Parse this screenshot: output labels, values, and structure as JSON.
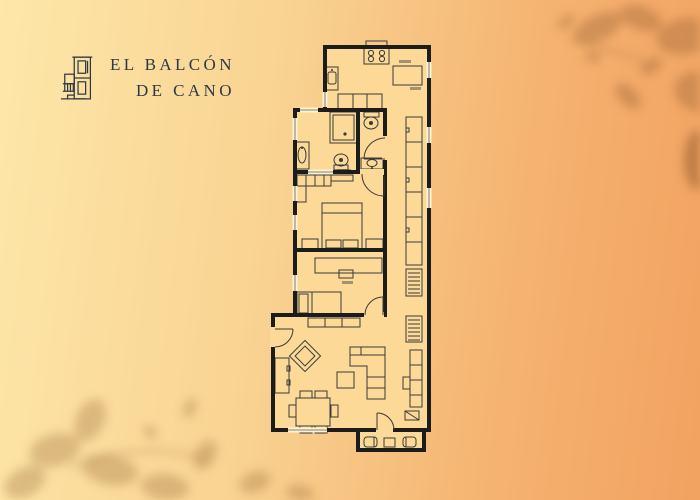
{
  "brand": {
    "line1": "EL BALCÓN",
    "line2": "DE CANO",
    "logo_icon": "building-icon"
  },
  "palette": {
    "bg_left": "#fde7a9",
    "bg_mid": "#f9d392",
    "bg_right": "#f2a261",
    "leaf_shadow": "#8a5526",
    "wall": "#1c1c1c",
    "floor": "#fcd997",
    "furniture_line": "#3a3a3a",
    "window": "#fdf2d2",
    "text": "#2e3a42"
  },
  "floorplan": {
    "regions": [
      "kitchen",
      "bathroom",
      "wc",
      "bedroom-1",
      "bedroom-2",
      "hallway",
      "living-dining-room",
      "balcony"
    ],
    "furniture_icons": [
      "stove-icon",
      "kitchen-sink-icon",
      "counter-icon",
      "shower-icon",
      "washbasin-icon",
      "toilet-icon",
      "wardrobe-icon",
      "double-bed-icon",
      "nightstand-icon",
      "desk-icon",
      "single-bed-icon",
      "sideboard-icon",
      "armchair-icon",
      "bookcase-icon",
      "dining-table-icon",
      "chair-icon",
      "sofa-icon",
      "coffee-table-icon",
      "tv-console-icon",
      "radiator-icon",
      "hall-closet-icon",
      "balcony-chair-icon",
      "balcony-table-icon",
      "door-arc-icon",
      "window-icon"
    ]
  },
  "decor": {
    "corner_shadows": [
      "leaf-shadow-top-right",
      "leaf-shadow-bottom-left"
    ]
  }
}
